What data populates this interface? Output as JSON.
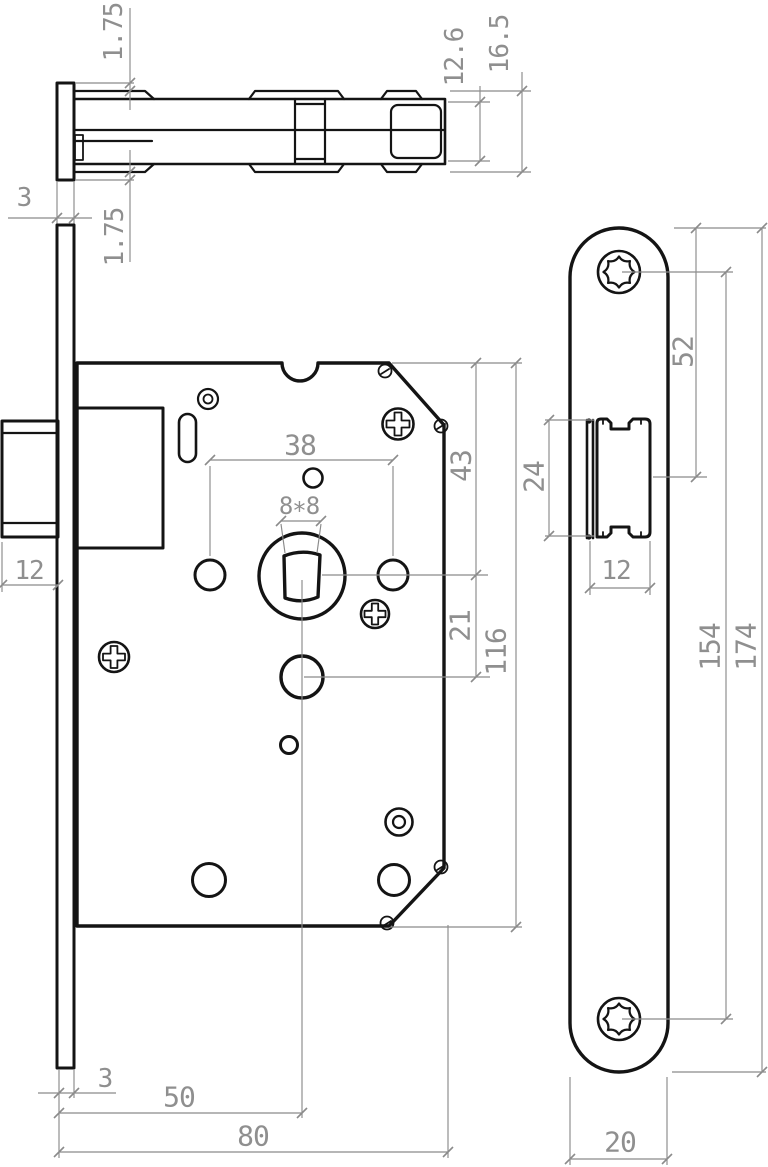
{
  "drawing": {
    "type": "mortise-lock-technical-drawing",
    "background": "#ffffff",
    "outline_color": "#141414",
    "dimension_color": "#8b8b8b",
    "icons": {
      "torx_screw": "8-lobe-star-in-circle",
      "phillips_screw": "cross-in-circle",
      "pivot_pin": "concentric-circles"
    },
    "views": {
      "top_view": {
        "description": "latch bolt assembly seen from above",
        "dims": {
          "plate_offset_top": "1.75",
          "latch_head_height": "12.6",
          "overall_height": "16.5",
          "faceplate_thickness": "3",
          "plate_offset_bottom": "1.75"
        }
      },
      "front_view": {
        "description": "lock case with spindle and follower holes",
        "dims": {
          "hole_spacing": "38",
          "top_to_spindle": "43",
          "spindle_square": "8∗8",
          "spindle_to_deadbolt": "21",
          "case_height": "116",
          "latch_protrusion": "12",
          "faceplate_thickness": "3",
          "backset": "50",
          "case_depth": "80"
        }
      },
      "side_view": {
        "description": "faceplate with torx screws and latch bolt",
        "dims": {
          "top_to_latch_center": "52",
          "latch_height": "24",
          "latch_width": "12",
          "screw_spacing": "154",
          "plate_length": "174",
          "plate_width": "20"
        }
      }
    }
  }
}
